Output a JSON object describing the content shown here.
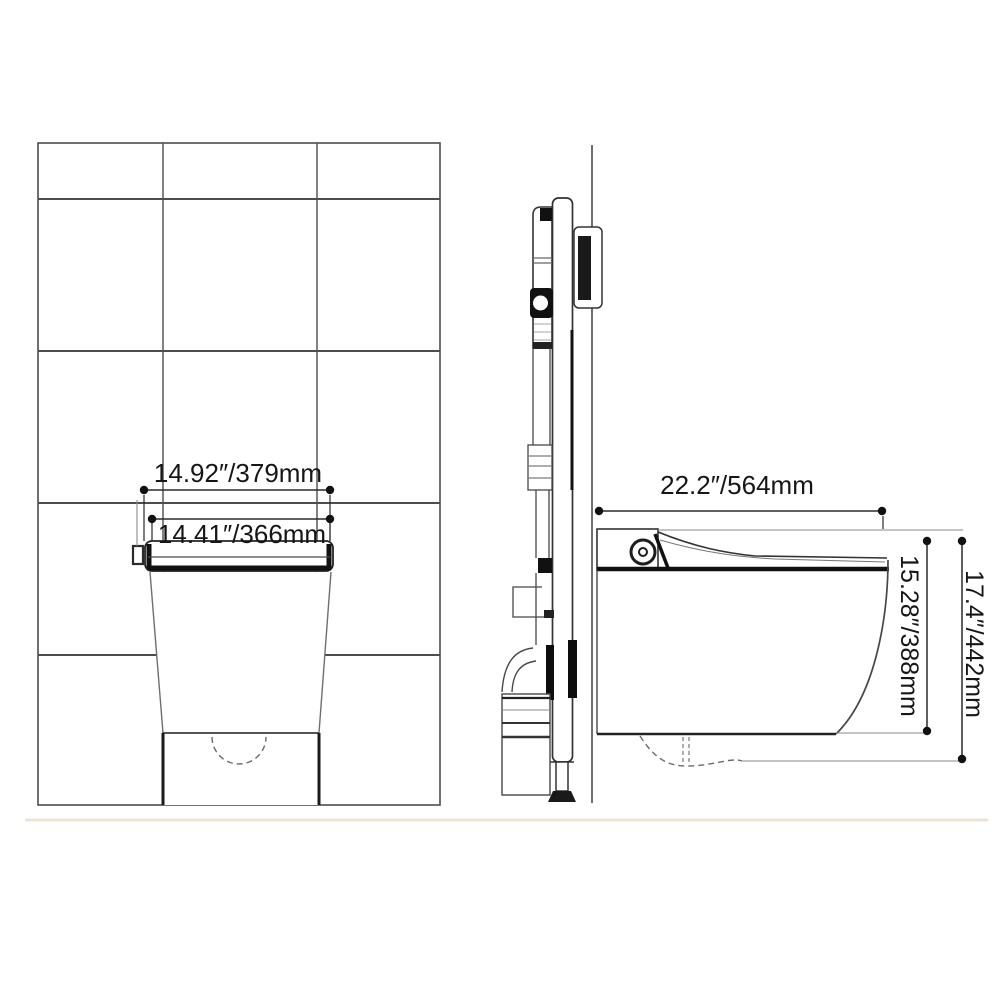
{
  "diagram": {
    "subject": "wall-hung-toilet-installation-dimensions",
    "front_view": {
      "label_outer_width": "14.92″/379mm",
      "label_inner_width": "14.41″/366mm"
    },
    "side_view": {
      "label_depth": "22.2″/564mm",
      "label_rim_height": "15.28″/388mm",
      "label_total_height": "17.4″/442mm"
    },
    "colors": {
      "tile_line": "#4d4d4d",
      "outline_dark": "#141414",
      "outline_gray": "#444444",
      "dimension": "#2a2a2a",
      "floor": "#e9e4d4",
      "background": "#ffffff"
    }
  }
}
